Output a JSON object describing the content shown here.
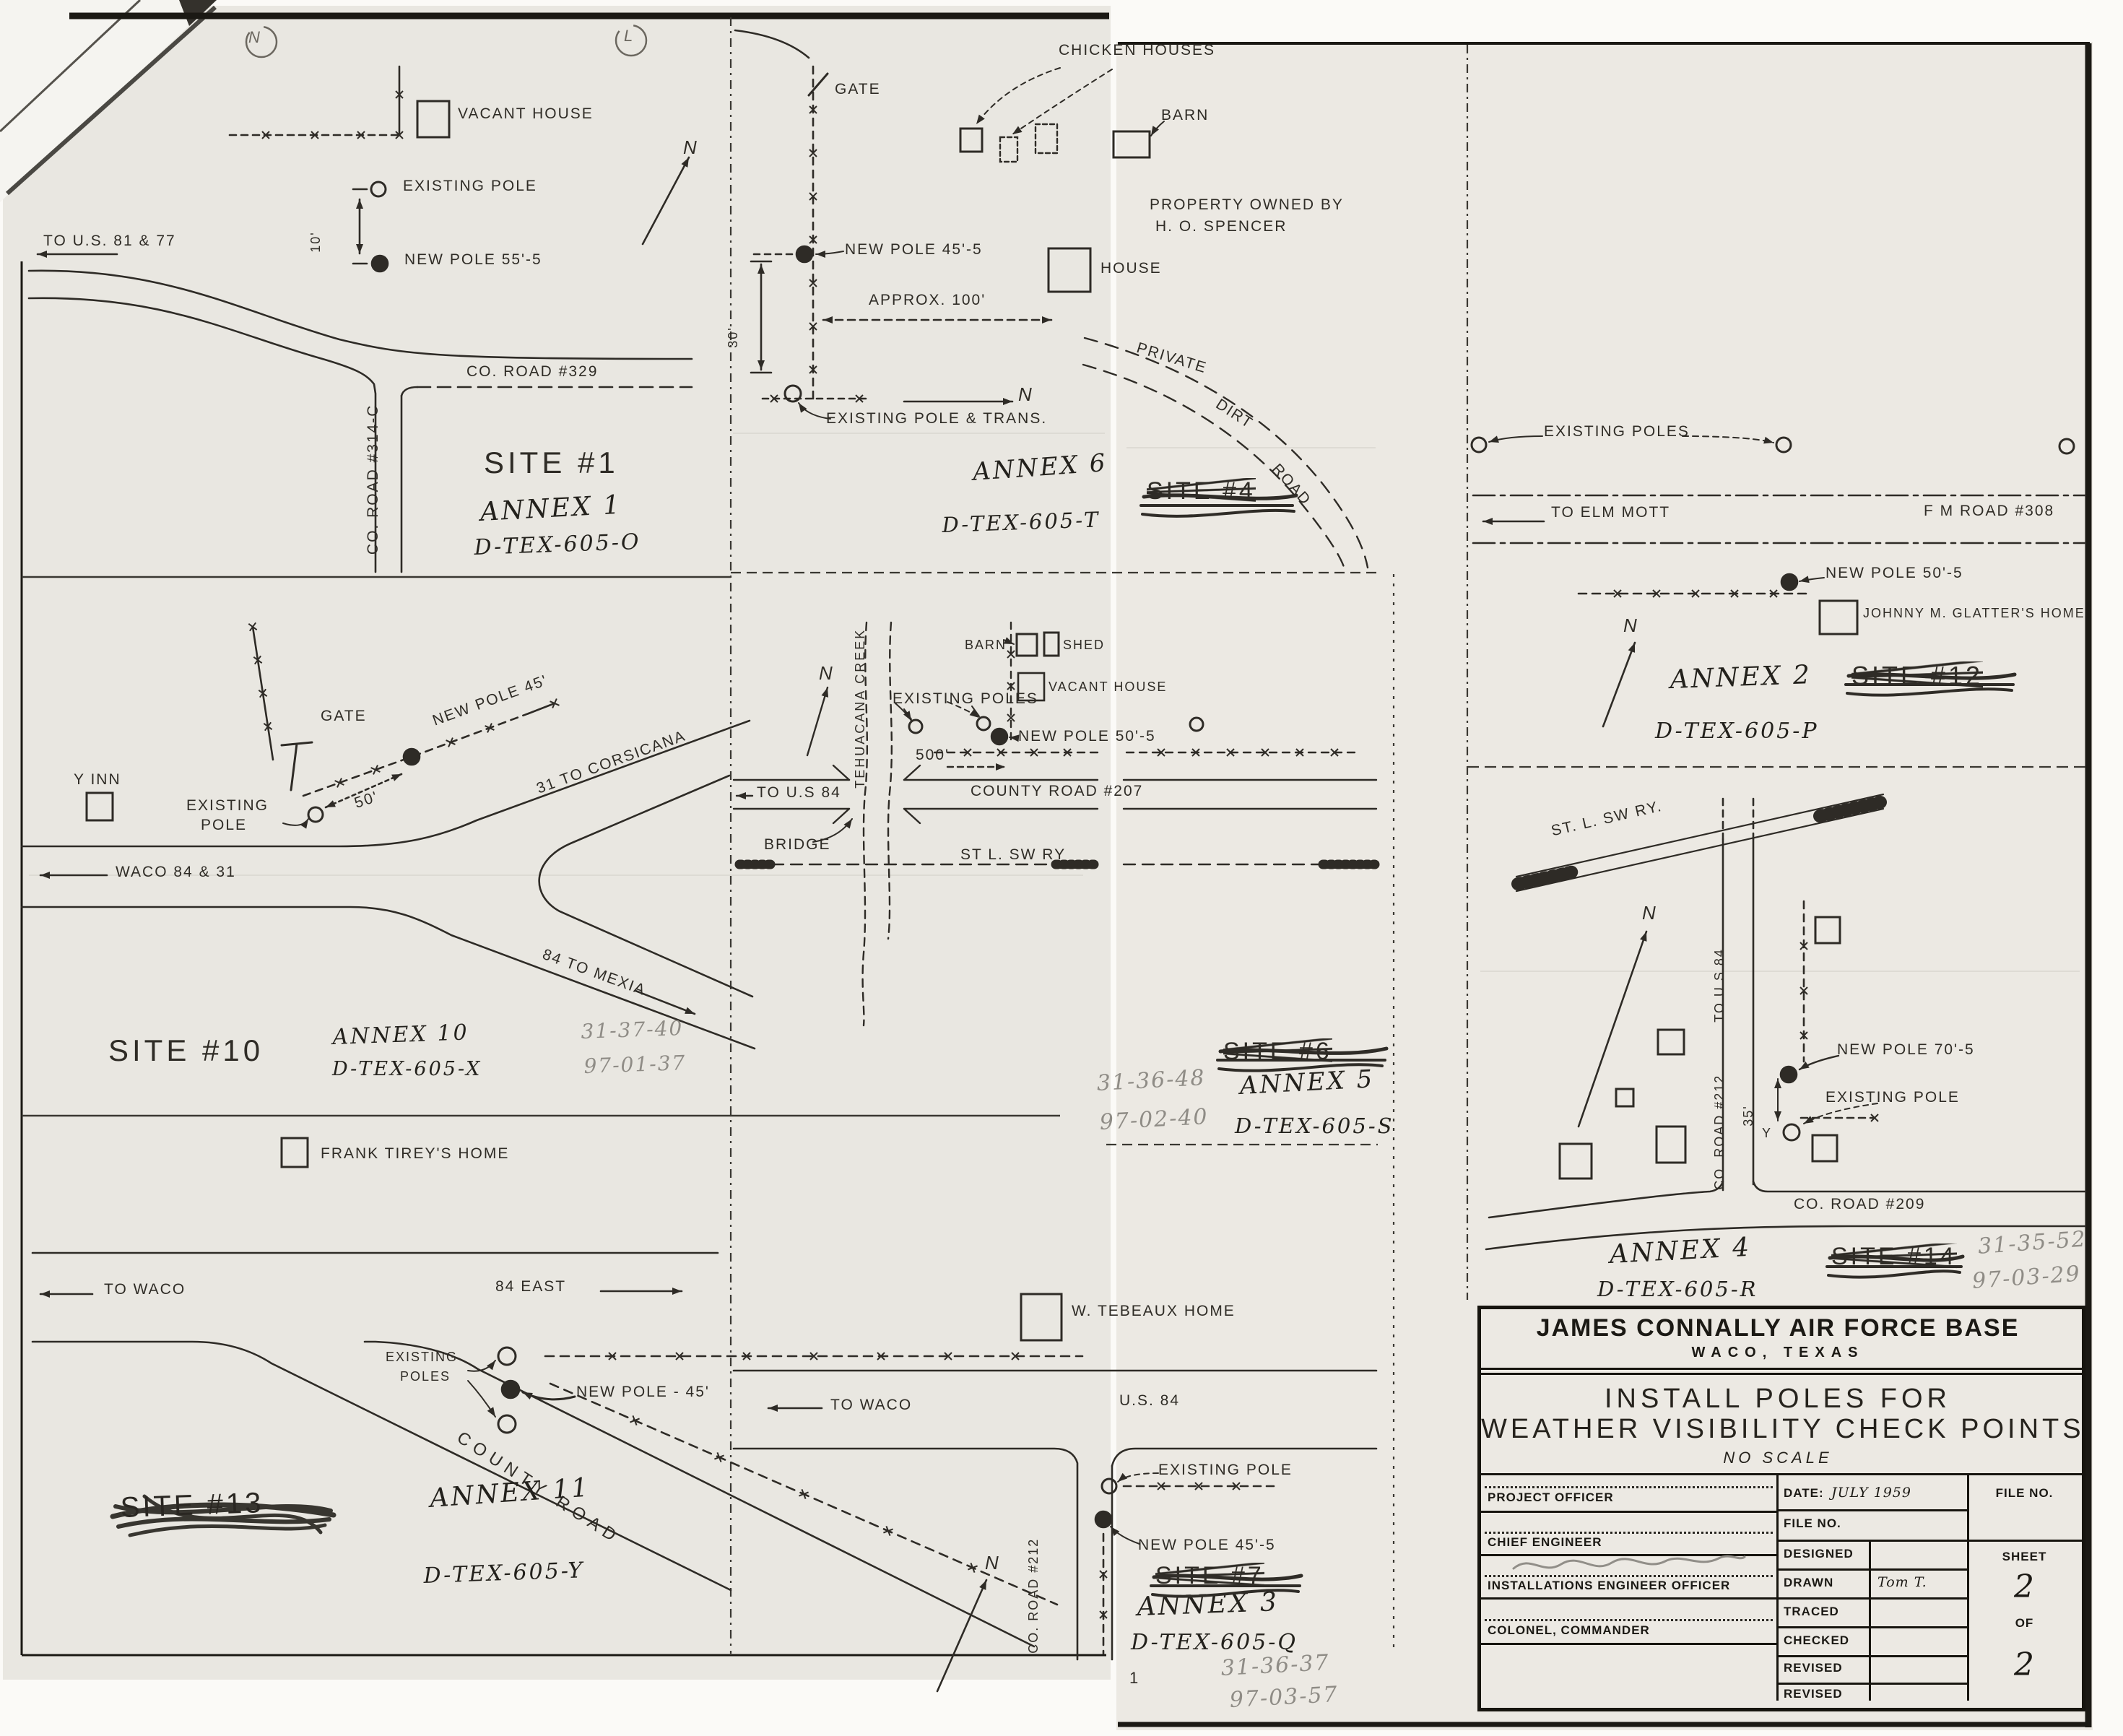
{
  "page": {
    "punch_left": "N",
    "punch_right": "L"
  },
  "site1": {
    "vacant_house": "VACANT HOUSE",
    "to_us": "TO U.S. 81 & 77",
    "existing_pole": "EXISTING POLE",
    "new_pole": "NEW POLE 55'-5",
    "dim_10": "10'",
    "co_road_329": "CO. ROAD #329",
    "co_road_314": "CO. ROAD #314-C",
    "north": "N",
    "site": "SITE #1",
    "annex": "ANNEX 1",
    "drawing_no": "D-TEX-605-O"
  },
  "site10": {
    "y_inn": "Y INN",
    "gate": "GATE",
    "new_pole": "NEW POLE 45'",
    "existing_line1": "EXISTING",
    "existing_line2": "POLE",
    "dim_50": "50'",
    "to_corsicana": "31 TO CORSICANA",
    "waco": "WACO 84 & 31",
    "to_mexia": "84 TO MEXIA",
    "site": "SITE #10",
    "annex": "ANNEX 10",
    "drawing_no": "D-TEX-605-X",
    "ref_a": "31-37-40",
    "ref_b": "97-01-37",
    "tirey": "FRANK TIREY'S HOME"
  },
  "annex11": {
    "to_waco": "TO WACO",
    "east": "84 EAST",
    "existing_line1": "EXISTING",
    "existing_line2": "POLES",
    "new_pole": "NEW POLE - 45'",
    "county_road": "COUNTY ROAD",
    "site_struck": "SITE #13",
    "annex": "ANNEX 11",
    "drawing_no": "D-TEX-605-Y"
  },
  "annex6": {
    "gate": "GATE",
    "chicken_houses": "CHICKEN HOUSES",
    "barn": "BARN",
    "property_line1": "PROPERTY OWNED BY",
    "property_line2": "H. O. SPENCER",
    "house": "HOUSE",
    "new_pole": "NEW POLE 45'-5",
    "approx": "APPROX. 100'",
    "dim_30": "30'",
    "existing": "EXISTING POLE & TRANS.",
    "private": "PRIVATE",
    "dirt": "DIRT",
    "road": "ROAD",
    "north": "N",
    "site_struck": "SITE #4",
    "annex": "ANNEX 6",
    "drawing_no": "D-TEX-605-T"
  },
  "annex5": {
    "north": "N",
    "creek": "TEHUACANA CREEK",
    "existing_poles": "EXISTING POLES",
    "barn": "BARN",
    "shed": "SHED",
    "vacant_house": "VACANT HOUSE",
    "new_pole": "NEW POLE 50'-5",
    "dim_500": "500'",
    "to_us84": "TO U.S 84",
    "county_road_207": "COUNTY ROAD #207",
    "bridge": "BRIDGE",
    "railway": "ST L. SW RY",
    "site_struck": "SITE #6",
    "annex": "ANNEX 5",
    "drawing_no": "D-TEX-605-S",
    "ref_a": "31-36-48",
    "ref_b": "97-02-40"
  },
  "annex3": {
    "tebeaux": "W. TEBEAUX HOME",
    "to_waco": "TO WACO",
    "us84": "U.S. 84",
    "existing_pole": "EXISTING POLE",
    "new_pole": "NEW POLE 45'-5",
    "co_road_212": "CO. ROAD #212",
    "north": "N",
    "site_struck": "SITE #7",
    "annex": "ANNEX 3",
    "drawing_no": "D-TEX-605-Q",
    "ref_a": "31-36-37",
    "ref_b": "97-03-57",
    "page_no": "1"
  },
  "annex2": {
    "existing_poles": "EXISTING POLES",
    "to_elm_mott": "TO ELM MOTT",
    "fm_road_308": "F M ROAD #308",
    "new_pole": "NEW POLE 50'-5",
    "glatter": "JOHNNY M. GLATTER'S HOME",
    "north": "N",
    "annex": "ANNEX 2",
    "drawing_no": "D-TEX-605-P",
    "site_struck": "SITE #12"
  },
  "annex4": {
    "railway": "ST. L. SW RY.",
    "north": "N",
    "to_us84": "TO U S 84",
    "co_road_212": "CO. ROAD #212",
    "dim_35": "35'",
    "y_mark": "Y",
    "new_pole": "NEW POLE 70'-5",
    "existing_pole": "EXISTING POLE",
    "co_road_209": "CO. ROAD #209",
    "annex": "ANNEX 4",
    "drawing_no": "D-TEX-605-R",
    "site_struck": "SITE #14",
    "ref_a": "31-35-52",
    "ref_b": "97-03-29"
  },
  "title_block": {
    "organization": "JAMES CONNALLY AIR FORCE BASE",
    "location": "WACO, TEXAS",
    "title_line1": "INSTALL POLES FOR",
    "title_line2": "WEATHER VISIBILITY CHECK POINTS",
    "scale_note": "NO SCALE",
    "date_label": "DATE:",
    "date_value": "JULY 1959",
    "file_no_label": "FILE NO.",
    "file_no_label2": "FILE NO.",
    "designed": "DESIGNED",
    "drawn": "DRAWN",
    "drawn_value": "Tom T.",
    "traced": "TRACED",
    "checked": "CHECKED",
    "revised_1": "REVISED",
    "revised_2": "REVISED",
    "sheet_label": "SHEET",
    "sheet_no": "2",
    "of_label": "OF",
    "sheet_total": "2",
    "project_officer": "PROJECT OFFICER",
    "chief_engineer": "CHIEF ENGINEER",
    "installations_officer": "INSTALLATIONS ENGINEER OFFICER",
    "commander": "COLONEL, COMMANDER"
  }
}
